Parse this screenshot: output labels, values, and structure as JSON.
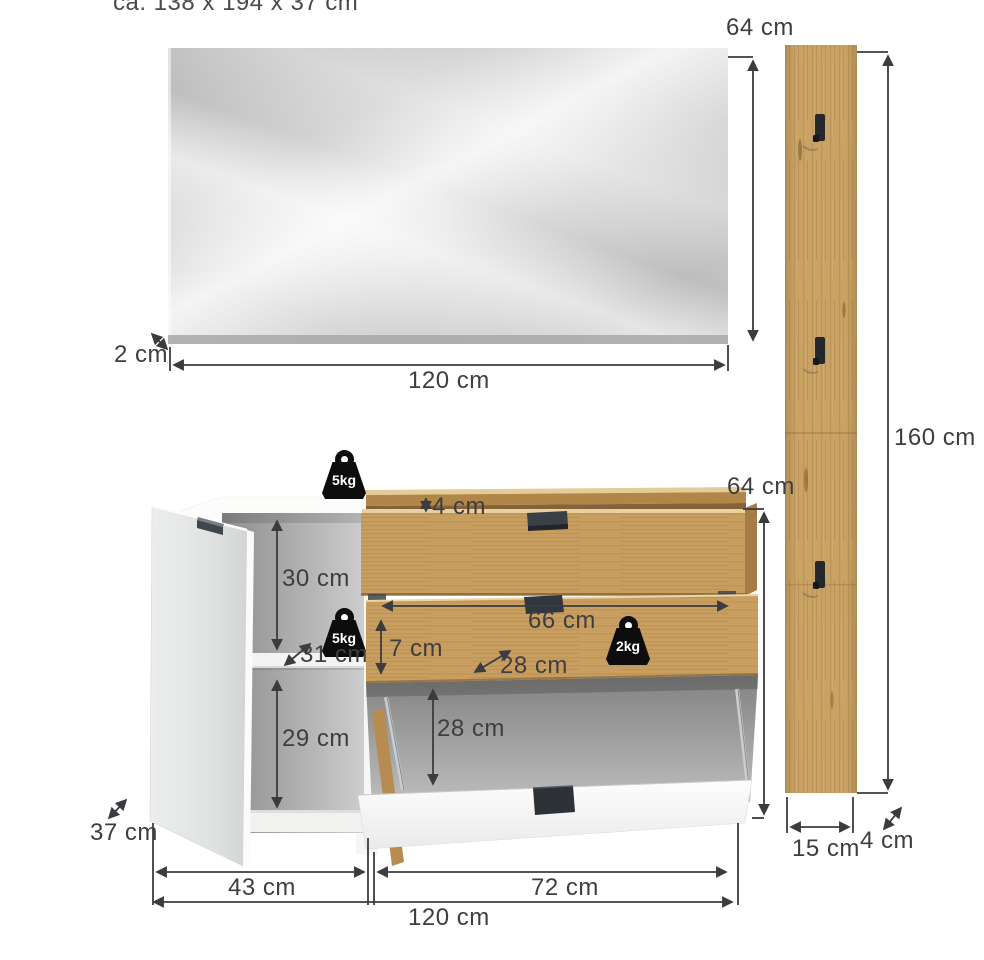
{
  "header": {
    "overall_size": "ca. 138 x 194 x 37 cm"
  },
  "mirror": {
    "height_label": "64 cm",
    "thickness_label": "2 cm",
    "width_label": "120 cm"
  },
  "panel": {
    "height_label": "160 cm",
    "width_label": "15 cm",
    "depth_label": "4 cm"
  },
  "cabinet": {
    "top_load_label": "5kg",
    "shelf_load_label": "5kg",
    "flap_load_label": "2kg",
    "height_label": "64 cm",
    "box_rim_label": "4 cm",
    "upper_compartment_label": "30 cm",
    "shelf_depth_label": "31 cm",
    "lower_compartment_label": "29 cm",
    "flap_width_label": "66 cm",
    "flap_front_label": "7 cm",
    "flap_depth_label": "28 cm",
    "flap_opening_label": "28 cm",
    "door_width_label": "43 cm",
    "flap_section_width_label": "72 cm",
    "total_width_label": "120 cm",
    "depth_label": "37 cm"
  },
  "colors": {
    "wood": "#c9a364",
    "dimension_line": "#3b3b40",
    "weight_icon": "#0d0d0d",
    "mirror_gray": "#c4c4c4"
  }
}
